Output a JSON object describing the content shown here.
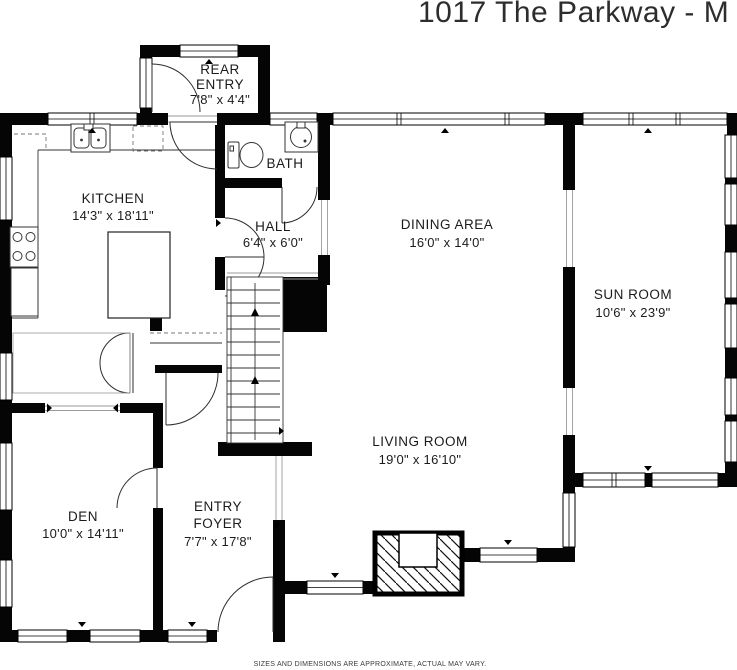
{
  "title": "1017 The Parkway - M",
  "disclaimer": "SIZES AND DIMENSIONS ARE APPROXIMATE, ACTUAL MAY VARY.",
  "rooms": {
    "rear_entry": {
      "line1": "REAR",
      "line2": "ENTRY",
      "dims": "7'8\" x 4'4\""
    },
    "kitchen": {
      "name": "KITCHEN",
      "dims": "14'3\" x 18'11\""
    },
    "bath": {
      "name": "BATH"
    },
    "hall": {
      "name": "HALL",
      "dims": "6'4\" x 6'0\""
    },
    "dining_area": {
      "name": "DINING AREA",
      "dims": "16'0\" x 14'0\""
    },
    "sun_room": {
      "name": "SUN ROOM",
      "dims": "10'6\" x 23'9\""
    },
    "living_room": {
      "name": "LIVING ROOM",
      "dims": "19'0\" x 16'10\""
    },
    "den": {
      "name": "DEN",
      "dims": "10'0\" x 14'11\""
    },
    "entry_foyer": {
      "line1": "ENTRY",
      "line2": "FOYER",
      "dims": "7'7\" x 17'8\""
    }
  }
}
